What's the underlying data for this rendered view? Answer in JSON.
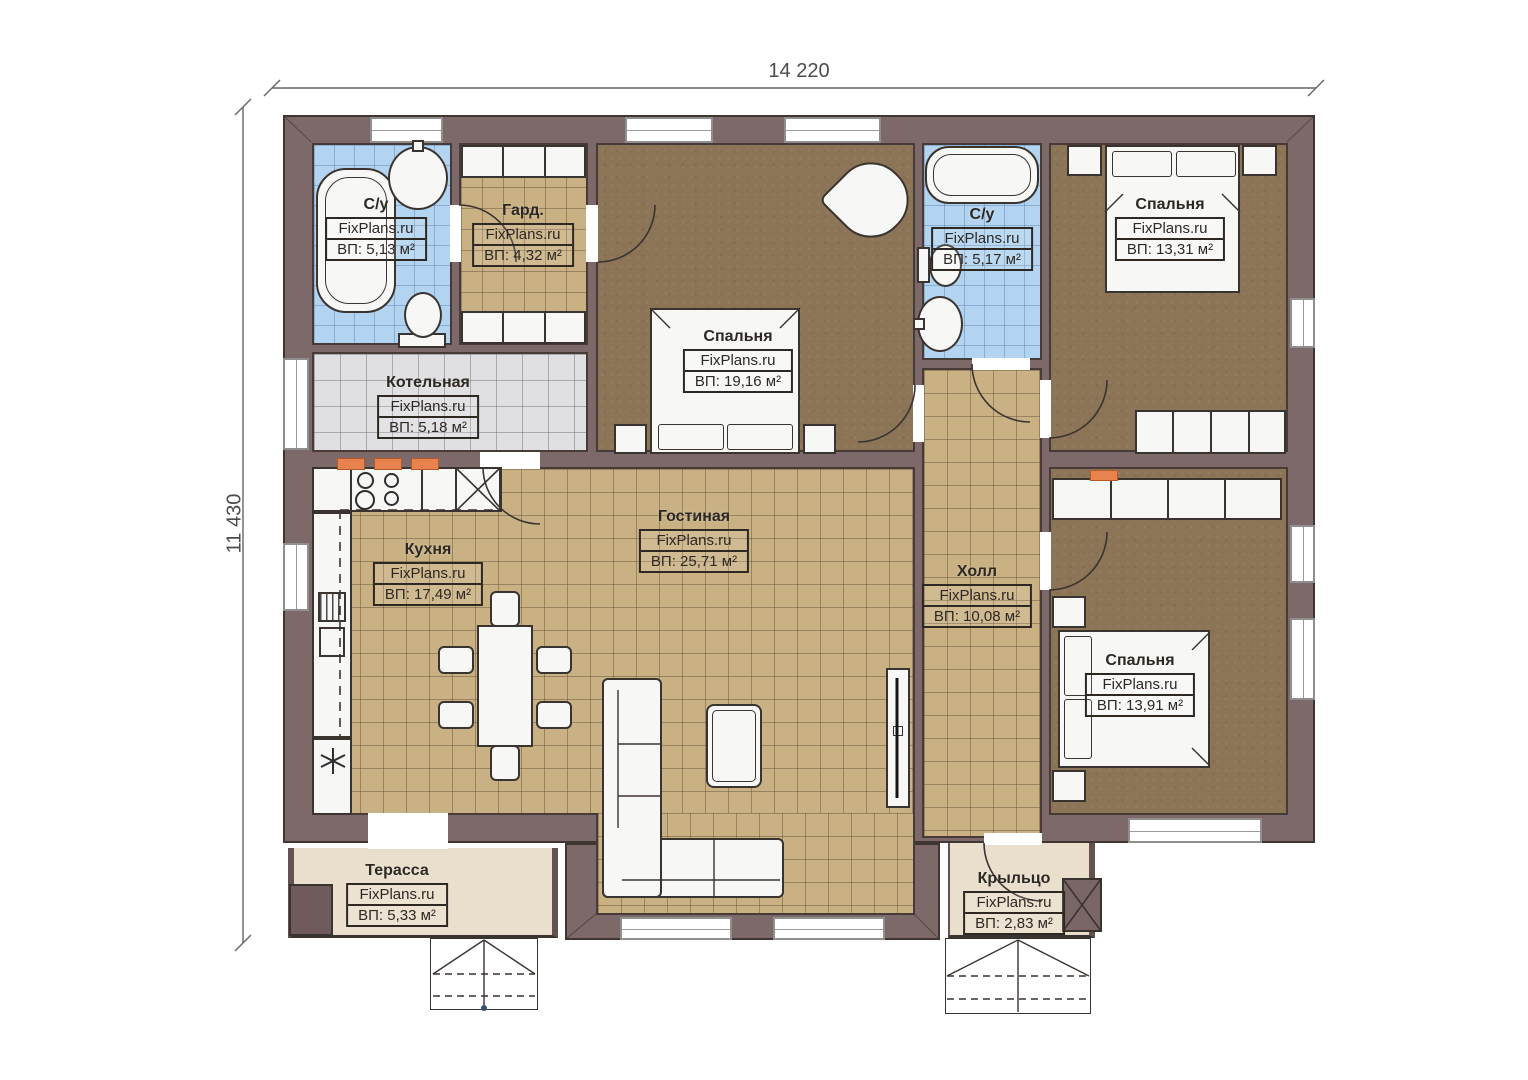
{
  "meta": {
    "width_label": "14 220",
    "height_label": "11 430"
  },
  "colors": {
    "wall": "#7d696a",
    "floor_dark": "#8c7457",
    "tile_tan": "#c9b183",
    "tile_blue": "#b3d4f1",
    "tile_gray": "#e0e0e2",
    "terrace_beige": "#e9dfcc",
    "radiator_orange": "#e8834f",
    "linework": "#3a3430"
  },
  "rooms": [
    {
      "id": "bath-1",
      "name": "С/у",
      "watermark": "FixPlans.ru",
      "area": "ВП: 5,13 м²"
    },
    {
      "id": "wardrobe",
      "name": "Гард.",
      "watermark": "FixPlans.ru",
      "area": "ВП: 4,32 м²"
    },
    {
      "id": "bedroom-middle",
      "name": "Спальня",
      "watermark": "FixPlans.ru",
      "area": "ВП: 19,16 м²"
    },
    {
      "id": "bath-2",
      "name": "С/у",
      "watermark": "FixPlans.ru",
      "area": "ВП: 5,17 м²"
    },
    {
      "id": "bedroom-top-right",
      "name": "Спальня",
      "watermark": "FixPlans.ru",
      "area": "ВП: 13,31 м²"
    },
    {
      "id": "boiler-room",
      "name": "Котельная",
      "watermark": "FixPlans.ru",
      "area": "ВП: 5,18 м²"
    },
    {
      "id": "kitchen",
      "name": "Кухня",
      "watermark": "FixPlans.ru",
      "area": "ВП: 17,49 м²"
    },
    {
      "id": "living-room",
      "name": "Гостиная",
      "watermark": "FixPlans.ru",
      "area": "ВП: 25,71 м²"
    },
    {
      "id": "hall",
      "name": "Холл",
      "watermark": "FixPlans.ru",
      "area": "ВП: 10,08 м²"
    },
    {
      "id": "bedroom-bottom-right",
      "name": "Спальня",
      "watermark": "FixPlans.ru",
      "area": "ВП: 13,91 м²"
    },
    {
      "id": "terrace",
      "name": "Терасса",
      "watermark": "FixPlans.ru",
      "area": "ВП: 5,33 м²"
    },
    {
      "id": "porch",
      "name": "Крыльцо",
      "watermark": "FixPlans.ru",
      "area": "ВП: 2,83 м²"
    }
  ]
}
